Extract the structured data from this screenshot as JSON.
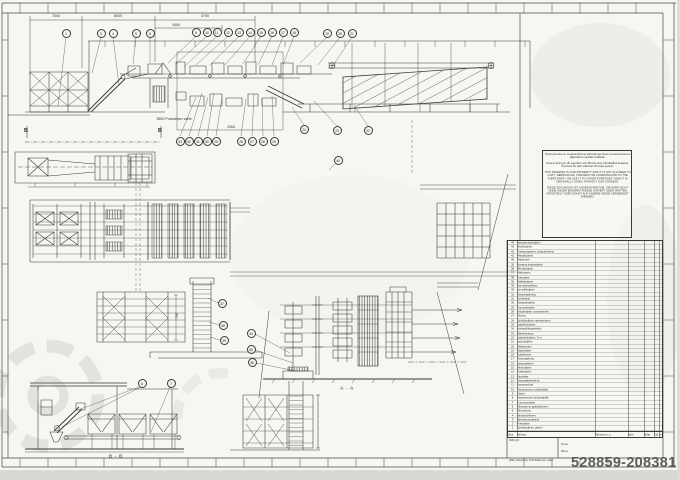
{
  "sheet": {
    "watermark": "528859-20838177",
    "footer_note": "(RE) Wood Oy  Puhdistamon valm.",
    "kuva_label": "Kuva",
    "muut_label": "Muut",
    "nim_ryh": "NIM ryh"
  },
  "colors": {
    "paper": "#f7f6f3",
    "ink": "#3a3834",
    "watermark_gray": "#4b4a47"
  },
  "legal": {
    "fi": "Tämä piirustus on omaisuuttamme eikä sitä saa ilman suostumustamme jäljentää tai näyttää sivullisille.",
    "sv": "Denna ritning är vår egendom och får icke utan vårt tillstånd kopieras, förevisas för eller utlämnas till tredje person.",
    "en": "THIS DRAWING IS OUR PROPERTY AND IT IS NOT ALLOWED TO COPY, REPRODUCE, TRANSMIT OR COMMUNICATE TO THE THIRD PARTY OR USE IT TO OTHER PURPOSES THAN IT IS ORIGINALLY GIVEN, WITHOUT OUR CONSENT.",
    "de": "DIESE ZEICHNUNG IST UNSER EIGENTUM. SIE DARF NICHT OHNE UNSER EINVERSTÄNDNIS KOPIERT ODER DRITTEN MITGETEILT ODER SONST AUF ANDERE WEISE VERWENDET WERDEN."
  },
  "annotations": [
    {
      "t": "7004",
      "x": 56,
      "y": 16,
      "cls": "dim"
    },
    {
      "t": "8000",
      "x": 118,
      "y": 16,
      "cls": "dim"
    },
    {
      "t": "4700",
      "x": 205,
      "y": 16,
      "cls": "dim"
    },
    {
      "t": "3454",
      "x": 176,
      "y": 25,
      "cls": "dim"
    },
    {
      "t": "3500 Purkaimen varte",
      "x": 174,
      "y": 119,
      "cls": "dim"
    },
    {
      "t": "1064",
      "x": 231,
      "y": 127,
      "cls": "dim"
    },
    {
      "t": "750",
      "x": 177,
      "y": 316,
      "cls": "dimv"
    },
    {
      "t": "A - A",
      "x": 347,
      "y": 388,
      "cls": "sec"
    },
    {
      "t": "B - B",
      "x": 116,
      "y": 456,
      "cls": "sec"
    },
    {
      "t": "B",
      "x": 26,
      "y": 130,
      "cls": "secb"
    },
    {
      "t": "B",
      "x": 160,
      "y": 130,
      "cls": "secb"
    }
  ],
  "balloons": [
    {
      "n": "1",
      "x": 66,
      "y": 33
    },
    {
      "n": "3",
      "x": 101,
      "y": 33
    },
    {
      "n": "4",
      "x": 113,
      "y": 33
    },
    {
      "n": "5",
      "x": 136,
      "y": 33
    },
    {
      "n": "8",
      "x": 150,
      "y": 33
    },
    {
      "n": "9",
      "x": 196,
      "y": 32
    },
    {
      "n": "10",
      "x": 207,
      "y": 32
    },
    {
      "n": "11",
      "x": 217,
      "y": 32
    },
    {
      "n": "12",
      "x": 228,
      "y": 32
    },
    {
      "n": "13",
      "x": 239,
      "y": 32
    },
    {
      "n": "14",
      "x": 250,
      "y": 32
    },
    {
      "n": "15",
      "x": 261,
      "y": 32
    },
    {
      "n": "16",
      "x": 272,
      "y": 32
    },
    {
      "n": "17",
      "x": 283,
      "y": 32
    },
    {
      "n": "18",
      "x": 294,
      "y": 32
    },
    {
      "n": "19",
      "x": 327,
      "y": 33
    },
    {
      "n": "20",
      "x": 340,
      "y": 33
    },
    {
      "n": "21",
      "x": 352,
      "y": 33
    },
    {
      "n": "33",
      "x": 180,
      "y": 141
    },
    {
      "n": "32",
      "x": 189,
      "y": 141
    },
    {
      "n": "31",
      "x": 198,
      "y": 141
    },
    {
      "n": "30",
      "x": 207,
      "y": 141
    },
    {
      "n": "29",
      "x": 216,
      "y": 141
    },
    {
      "n": "28",
      "x": 241,
      "y": 141
    },
    {
      "n": "27",
      "x": 252,
      "y": 141
    },
    {
      "n": "26",
      "x": 263,
      "y": 141
    },
    {
      "n": "25",
      "x": 274,
      "y": 141
    },
    {
      "n": "24",
      "x": 304,
      "y": 129
    },
    {
      "n": "23",
      "x": 337,
      "y": 130
    },
    {
      "n": "22",
      "x": 368,
      "y": 130
    },
    {
      "n": "40",
      "x": 338,
      "y": 160
    },
    {
      "n": "37",
      "x": 222,
      "y": 303
    },
    {
      "n": "38",
      "x": 223,
      "y": 325
    },
    {
      "n": "39",
      "x": 224,
      "y": 340
    },
    {
      "n": "34",
      "x": 251,
      "y": 333
    },
    {
      "n": "35",
      "x": 251,
      "y": 349
    },
    {
      "n": "36",
      "x": 252,
      "y": 362
    },
    {
      "n": "6",
      "x": 142,
      "y": 383
    },
    {
      "n": "7",
      "x": 171,
      "y": 383
    }
  ],
  "parts_table": {
    "headers": [
      "Osa",
      "Nimitys",
      "Piirustus n:o",
      "Aine",
      "Mitat",
      "Kpl",
      "Huom"
    ],
    "rows": [
      {
        "no": "44",
        "name": "Vastaanottokuljetin"
      },
      {
        "no": "43",
        "name": "Nivelkuljetin"
      },
      {
        "no": "42",
        "name": "Purkauslaitteen ohjauskeskus"
      },
      {
        "no": "41",
        "name": "Paluukuljetin"
      },
      {
        "no": "40",
        "name": "Paperointi"
      },
      {
        "no": "39",
        "name": "Nostava ketjukuljetin"
      },
      {
        "no": "38",
        "name": "Hihnakuljetin"
      },
      {
        "no": "37",
        "name": "Välikuljetin"
      },
      {
        "no": "36",
        "name": "Purkulaite"
      },
      {
        "no": "35",
        "name": "Palkkikuljetin"
      },
      {
        "no": "34",
        "name": "Kannatinpalkisto"
      },
      {
        "no": "33",
        "name": "Lamellikuljetin"
      },
      {
        "no": "32",
        "name": "Tasauslaitteisto"
      },
      {
        "no": "31",
        "name": "Syöttölaite"
      },
      {
        "no": "30",
        "name": "Kasauskuljetin"
      },
      {
        "no": "29",
        "name": "Annostelulaite"
      },
      {
        "no": "28",
        "name": "Ketjukuljetin varusteineen"
      },
      {
        "no": "27",
        "name": "Kiramo"
      },
      {
        "no": "26",
        "name": "Syöttökuljetin varusteineen"
      },
      {
        "no": "25",
        "name": "Lajittelukuljetin"
      },
      {
        "no": "24",
        "name": "Hydrauliikkayksikkö"
      },
      {
        "no": "23",
        "name": "Sähkökeskus"
      },
      {
        "no": "22",
        "name": "Lajittelukuljetin, 3 m"
      },
      {
        "no": "21",
        "name": "Lastukuljetin"
      },
      {
        "no": "20",
        "name": "Välitasanne"
      },
      {
        "no": "19",
        "name": "Kääntölaite"
      },
      {
        "no": "18",
        "name": "Tukitelineet"
      },
      {
        "no": "17",
        "name": "Tasausjalusta"
      },
      {
        "no": "16",
        "name": "Lastauslaituri"
      },
      {
        "no": "15",
        "name": "Vinokuljetin"
      },
      {
        "no": "14",
        "name": "Kolakuljetin"
      },
      {
        "no": "13",
        "name": "Kippilaite"
      },
      {
        "no": "12",
        "name": "Tasausjärjestelmä"
      },
      {
        "no": "11",
        "name": "Kasauspöytä"
      },
      {
        "no": "10",
        "name": "Tasausvaunu rullaradalla"
      },
      {
        "no": "9",
        "name": "Kiskot"
      },
      {
        "no": "8",
        "name": "Tasausvaunu siirtoradalla"
      },
      {
        "no": "7",
        "name": "Kuormauslaite"
      },
      {
        "no": "6",
        "name": "Siirtovaunu ajolaitteineen"
      },
      {
        "no": "5",
        "name": "Siirtovaunu"
      },
      {
        "no": "4",
        "name": "Varastotelineet"
      },
      {
        "no": "3",
        "name": "Vastaanottotaskut"
      },
      {
        "no": "2",
        "name": "Purkulaite"
      },
      {
        "no": "1",
        "name": "Syöttökuljetin, jakso I"
      }
    ]
  }
}
